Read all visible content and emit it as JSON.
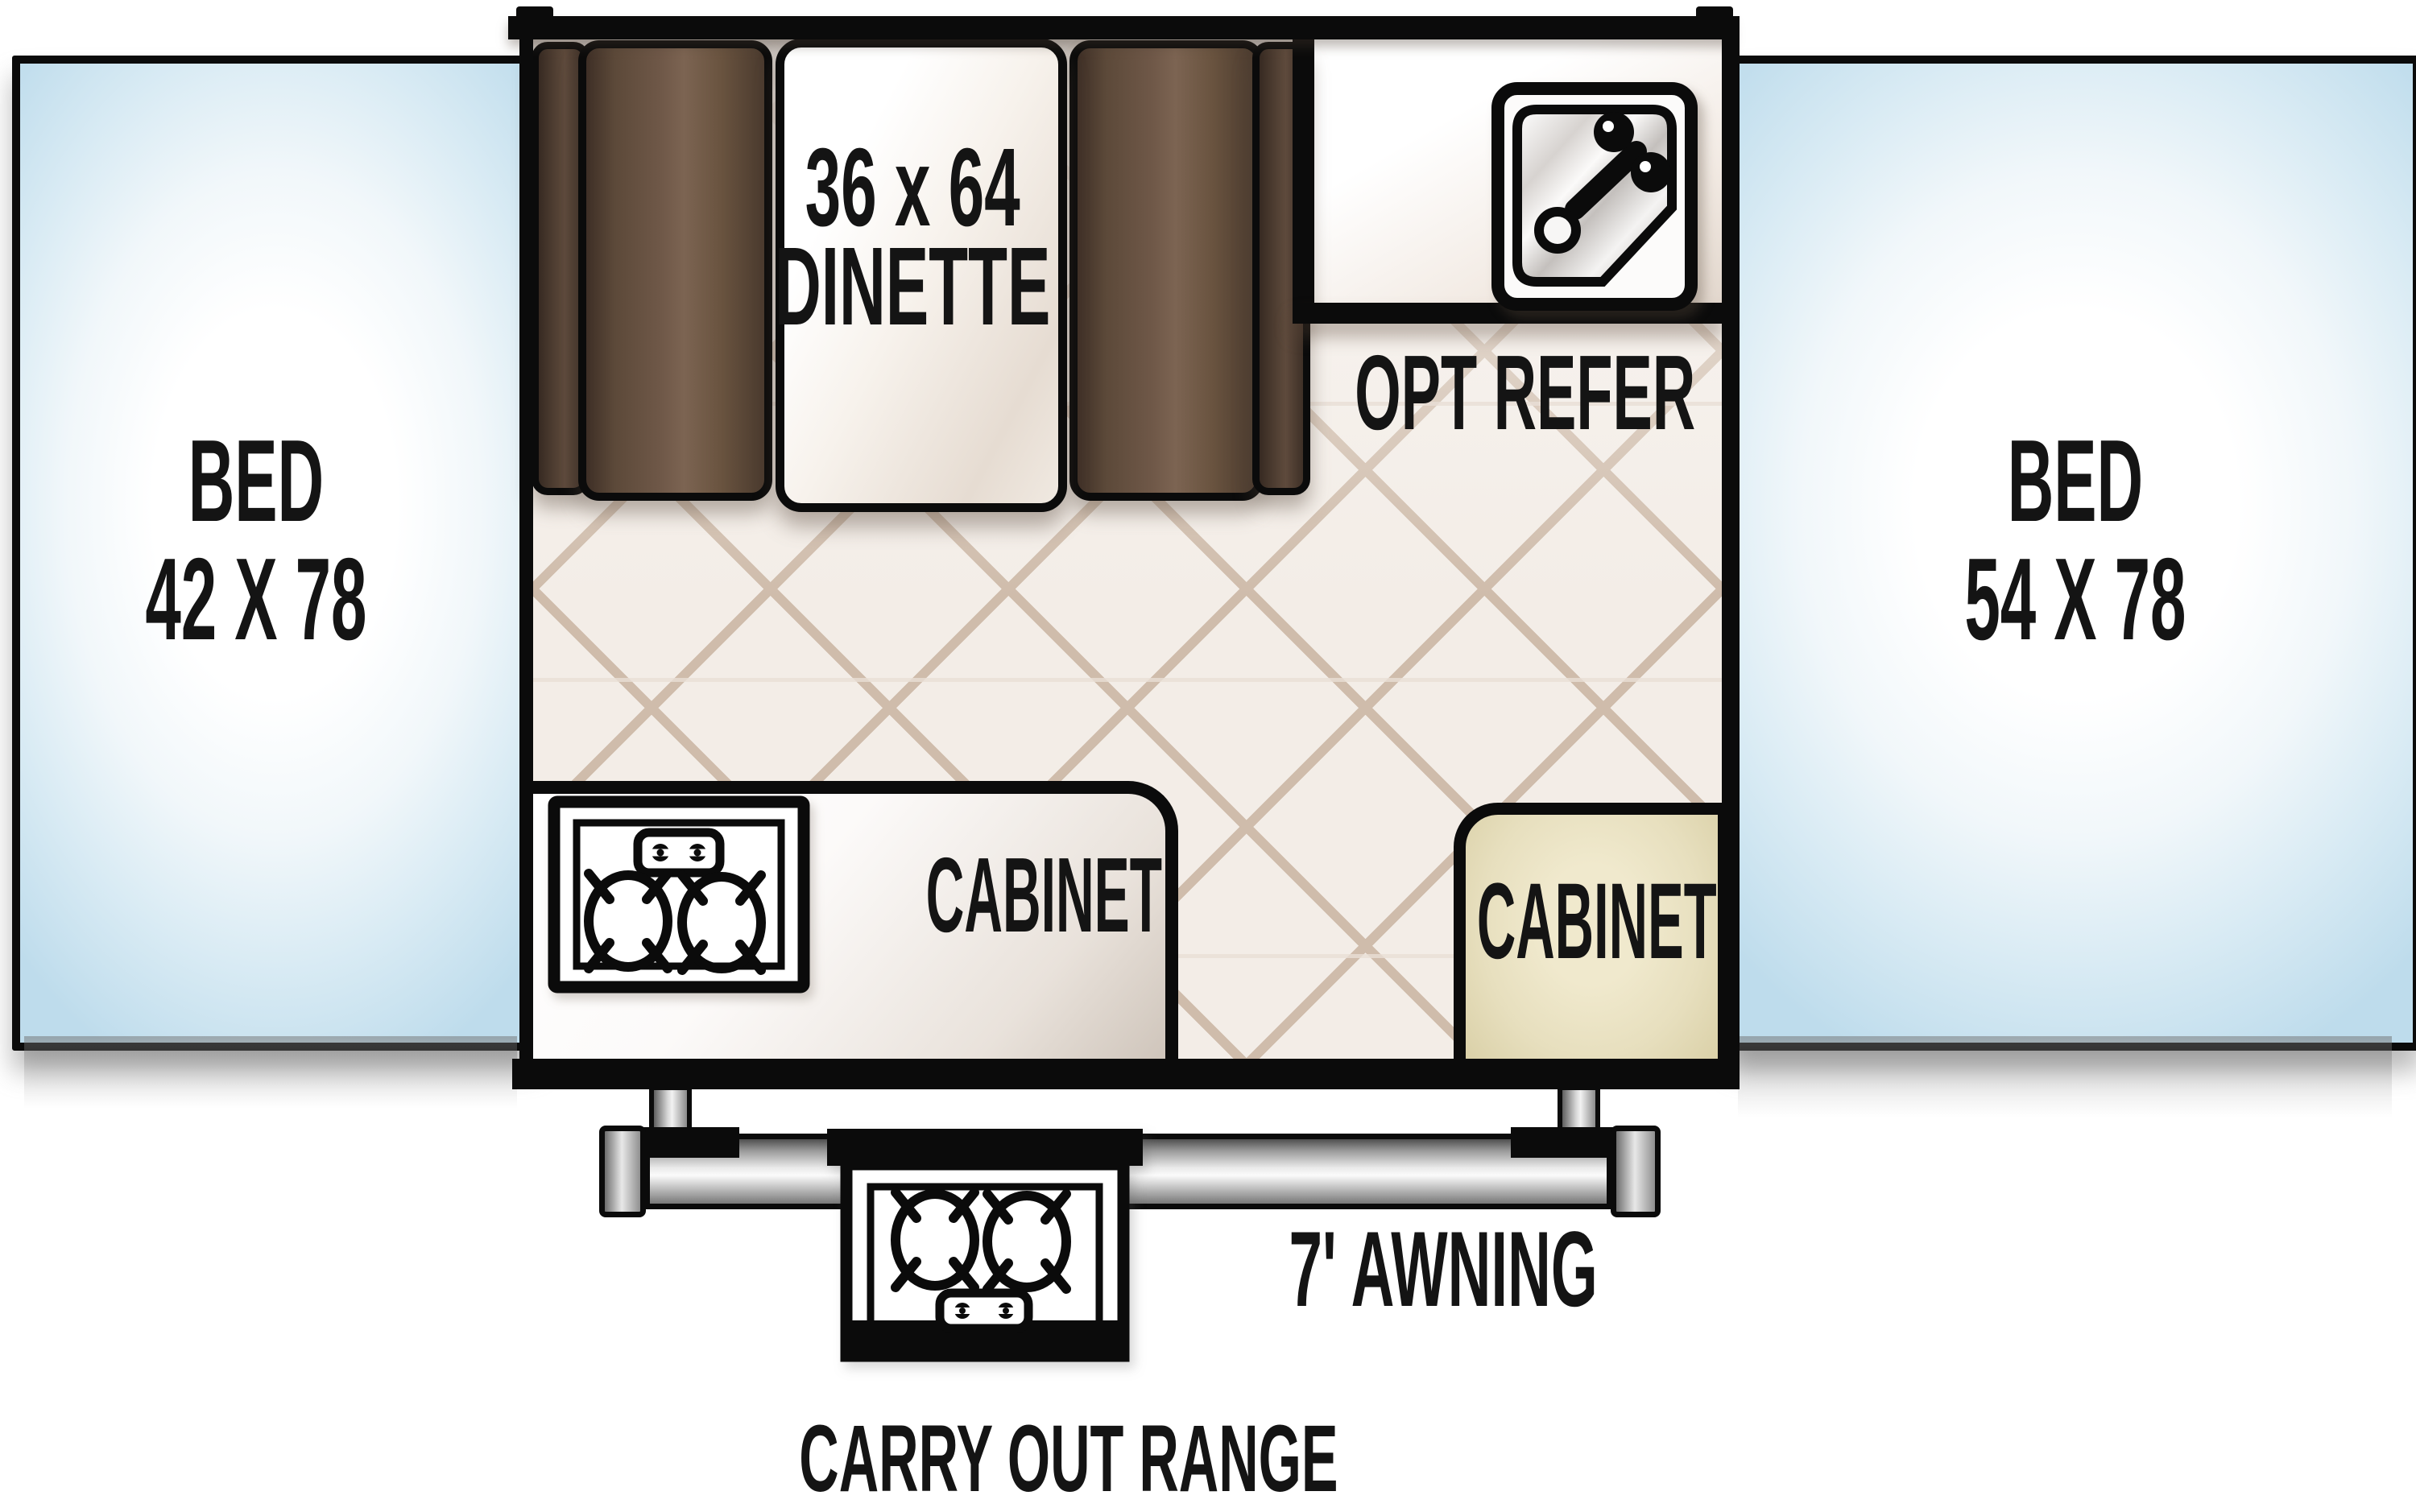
{
  "plan": {
    "bed_left": {
      "name": "BED",
      "size": "42 X 78"
    },
    "bed_right": {
      "name": "BED",
      "size": "54 X 78"
    },
    "dinette": {
      "size": "36 x 64",
      "name": "DINETTE"
    },
    "refrigerator": {
      "label": "OPT REFER"
    },
    "kitchen_cabinet": {
      "label": "CABINET"
    },
    "side_cabinet": {
      "label": "CABINET"
    },
    "awning": {
      "label": "7' AWNING"
    },
    "carry_out_range": {
      "label": "CARRY OUT RANGE"
    }
  },
  "colors": {
    "wall": "#0b0b0b",
    "bed_edge_blue": "#bedcec",
    "bed_center": "#ffffff",
    "cushion_dark_brown": "#3e2f26",
    "cushion_light_brown": "#7c6452",
    "table_white": "#f7f2ec",
    "tile_background": "#f3ede7",
    "tile_line": "#cfbcab",
    "cabinet_tan": "#e7dfbe",
    "counter_white": "#fcfaf9",
    "metal_light": "#f2f2f2",
    "metal_dark": "#5f5f5f",
    "text": "#141414"
  },
  "icons": {
    "sink": "sink-icon",
    "kitchen_cooktop": "cooktop-2-burner-icon",
    "carry_out_cooktop": "carry-out-range-2-burner-icon"
  }
}
